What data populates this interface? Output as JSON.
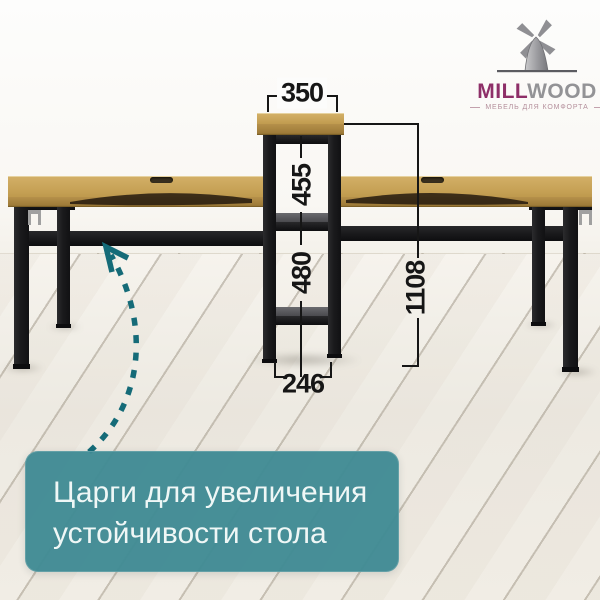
{
  "logo": {
    "brand_primary": "MILL",
    "brand_secondary": "WOOD",
    "tagline": "МЕБЕЛЬ ДЛЯ КОМФОРТА",
    "icon": "windmill-icon"
  },
  "dimensions": {
    "top_width": "350",
    "upper_section_height": "455",
    "lower_section_height": "480",
    "base_width": "246",
    "total_height": "1108"
  },
  "callout": {
    "line1": "Царги для увеличения",
    "line2": "устойчивости стола"
  },
  "colors": {
    "banner_teal": "#3f8a94",
    "arrow_teal": "#156b78",
    "brand_magenta": "#8e2f68",
    "brand_grey": "#939396",
    "wood": "#c7a258",
    "metal_black": "#1b1b1d",
    "dimension_line": "#161616",
    "floor": "#f1ede5"
  }
}
